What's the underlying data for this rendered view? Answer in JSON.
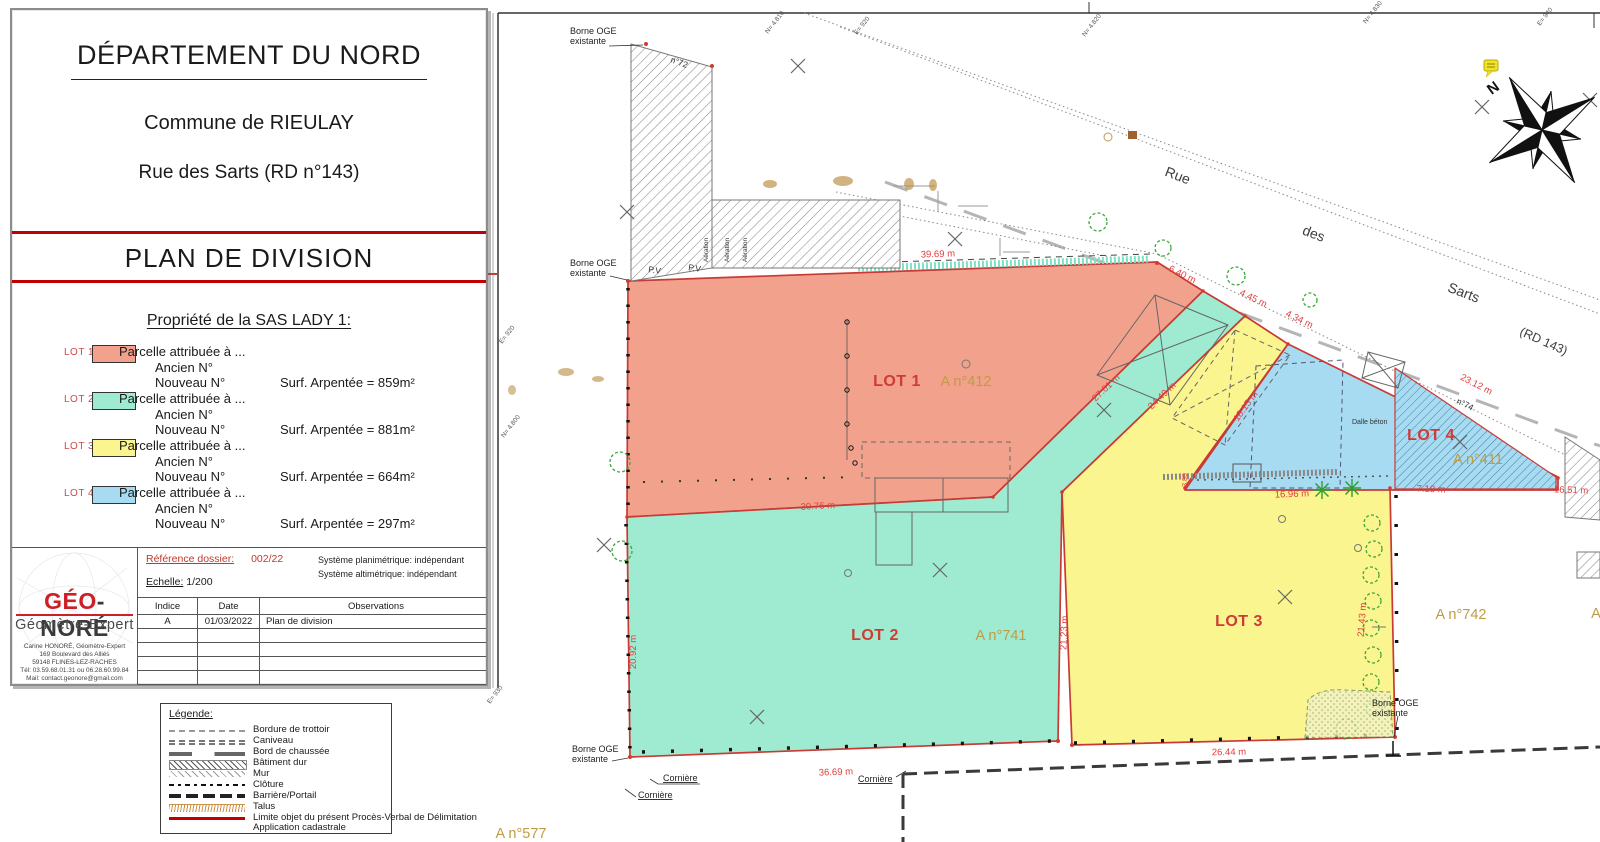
{
  "title_block": {
    "department": "DÉPARTEMENT DU NORD",
    "commune": "Commune de RIEULAY",
    "street": "Rue des Sarts (RD n°143)",
    "plan_title": "PLAN DE DIVISION",
    "property_heading": "Propriété de la SAS LADY 1:",
    "lots": [
      {
        "id": "LOT 1",
        "color": "#f2a28c",
        "line1": "Parcelle attribuée à ...",
        "line2": "Ancien N°",
        "line3": "Nouveau N°",
        "surface": "Surf. Arpentée = 859m²"
      },
      {
        "id": "LOT 2",
        "color": "#9febd2",
        "line1": "Parcelle attribuée à ...",
        "line2": "Ancien N°",
        "line3": "Nouveau N°",
        "surface": "Surf. Arpentée = 881m²"
      },
      {
        "id": "LOT 3",
        "color": "#faf58f",
        "line1": "Parcelle attribuée à ...",
        "line2": "Ancien N°",
        "line3": "Nouveau N°",
        "surface": "Surf. Arpentée = 664m²"
      },
      {
        "id": "LOT 4",
        "color": "#a6dbf2",
        "line1": "Parcelle attribuée à ...",
        "line2": "Ancien N°",
        "line3": "Nouveau N°",
        "surface": "Surf. Arpentée = 297m²"
      }
    ]
  },
  "firm_block": {
    "logo_red": "GÉO",
    "logo_dark": "-NORÉ",
    "logo_sub": "Géomètre-Expert",
    "address_lines": {
      "l1": "Carine HONORÉ, Géomètre-Expert",
      "l2": "169 Boulevard des Alliés",
      "l3": "59148 FLINES-LEZ-RACHES",
      "l4": "Tél: 03.59.68.01.31 ou 06.28.60.99.84",
      "l5": "Mail: contact.geonore@gmail.com"
    },
    "reference_label": "Référence dossier:",
    "reference_value": "002/22",
    "scale_label": "Echelle:",
    "scale_value": "1/200",
    "sys_plani": "Système planimétrique: indépendant",
    "sys_alti": "Système altimétrique: indépendant",
    "table": {
      "headers": {
        "indice": "Indice",
        "date": "Date",
        "observations": "Observations"
      },
      "row1": {
        "indice": "A",
        "date": "01/03/2022",
        "observations": "Plan de division"
      }
    }
  },
  "legend_box": {
    "title": "Légende:",
    "items": {
      "i1": "Bordure de trottoir",
      "i2": "Caniveau",
      "i3": "Bord de chaussée",
      "i4": "Bâtiment dur",
      "i5": "Mur",
      "i6": "Clôture",
      "i7": "Barrière/Portail",
      "i8": "Talus",
      "i9": "Limite objet du présent Procès-Verbal de Délimitation",
      "i10": "Application cadastrale"
    }
  },
  "plan": {
    "colors": {
      "lot1_fill": "#f2a28c",
      "lot2_fill": "#9febd2",
      "lot3_fill": "#faf58f",
      "lot4_fill": "#a6dbf2",
      "limit_red": "#c93a35",
      "measure_red": "#e04040",
      "parcel_tan": "#bf9b45",
      "tree_green": "#3aa63a"
    },
    "lot_labels": {
      "lot1": "LOT 1",
      "lot2": "LOT 2",
      "lot3": "LOT 3",
      "lot4": "LOT 4"
    },
    "parcel_labels": {
      "a412": "A n°412",
      "a741": "A n°741",
      "a742": "A n°742",
      "a411": "A n°411",
      "a577": "A n°577",
      "a_partial": "A"
    },
    "road_labels": {
      "w1": "Rue",
      "w2": "des",
      "w3": "Sarts",
      "w4": "(RD 143)"
    },
    "measurements": {
      "m_3969": "39.69 m",
      "m_640": "6.40 m",
      "m_445": "4.45 m",
      "m_434": "4.34 m",
      "m_2312": "23.12 m",
      "m_2761": "27.61 m",
      "m_2449": "24.49 m",
      "m_1815": "18.15 m",
      "m_3076": "30.76 m",
      "m_2092": "20.92 m",
      "m_2123": "21.23 m",
      "m_2143": "21.43 m",
      "m_1696": "16.96 m",
      "m_718": "7.18 m",
      "m_1651": "16.51 m",
      "m_2644": "26.44 m",
      "m_3669": "36.69 m",
      "m_385": "3.85"
    },
    "annotations": {
      "borne_l1": "Borne OGE",
      "borne_l2": "existante",
      "corniere": "Cornière",
      "n72": "n°72",
      "n74": "n°74",
      "dalle": "Dalle béton",
      "aeration": "Aération",
      "pv": "P.V",
      "north": "N"
    },
    "coord_labels": {
      "c1": "N= 4.810",
      "c2": "E= 920",
      "c3": "N= 4.820",
      "c4": "N= 4.830",
      "c5": "E= 940",
      "c6": "E= 920",
      "c7": "N= 4.800",
      "c8": "E= 930"
    }
  }
}
